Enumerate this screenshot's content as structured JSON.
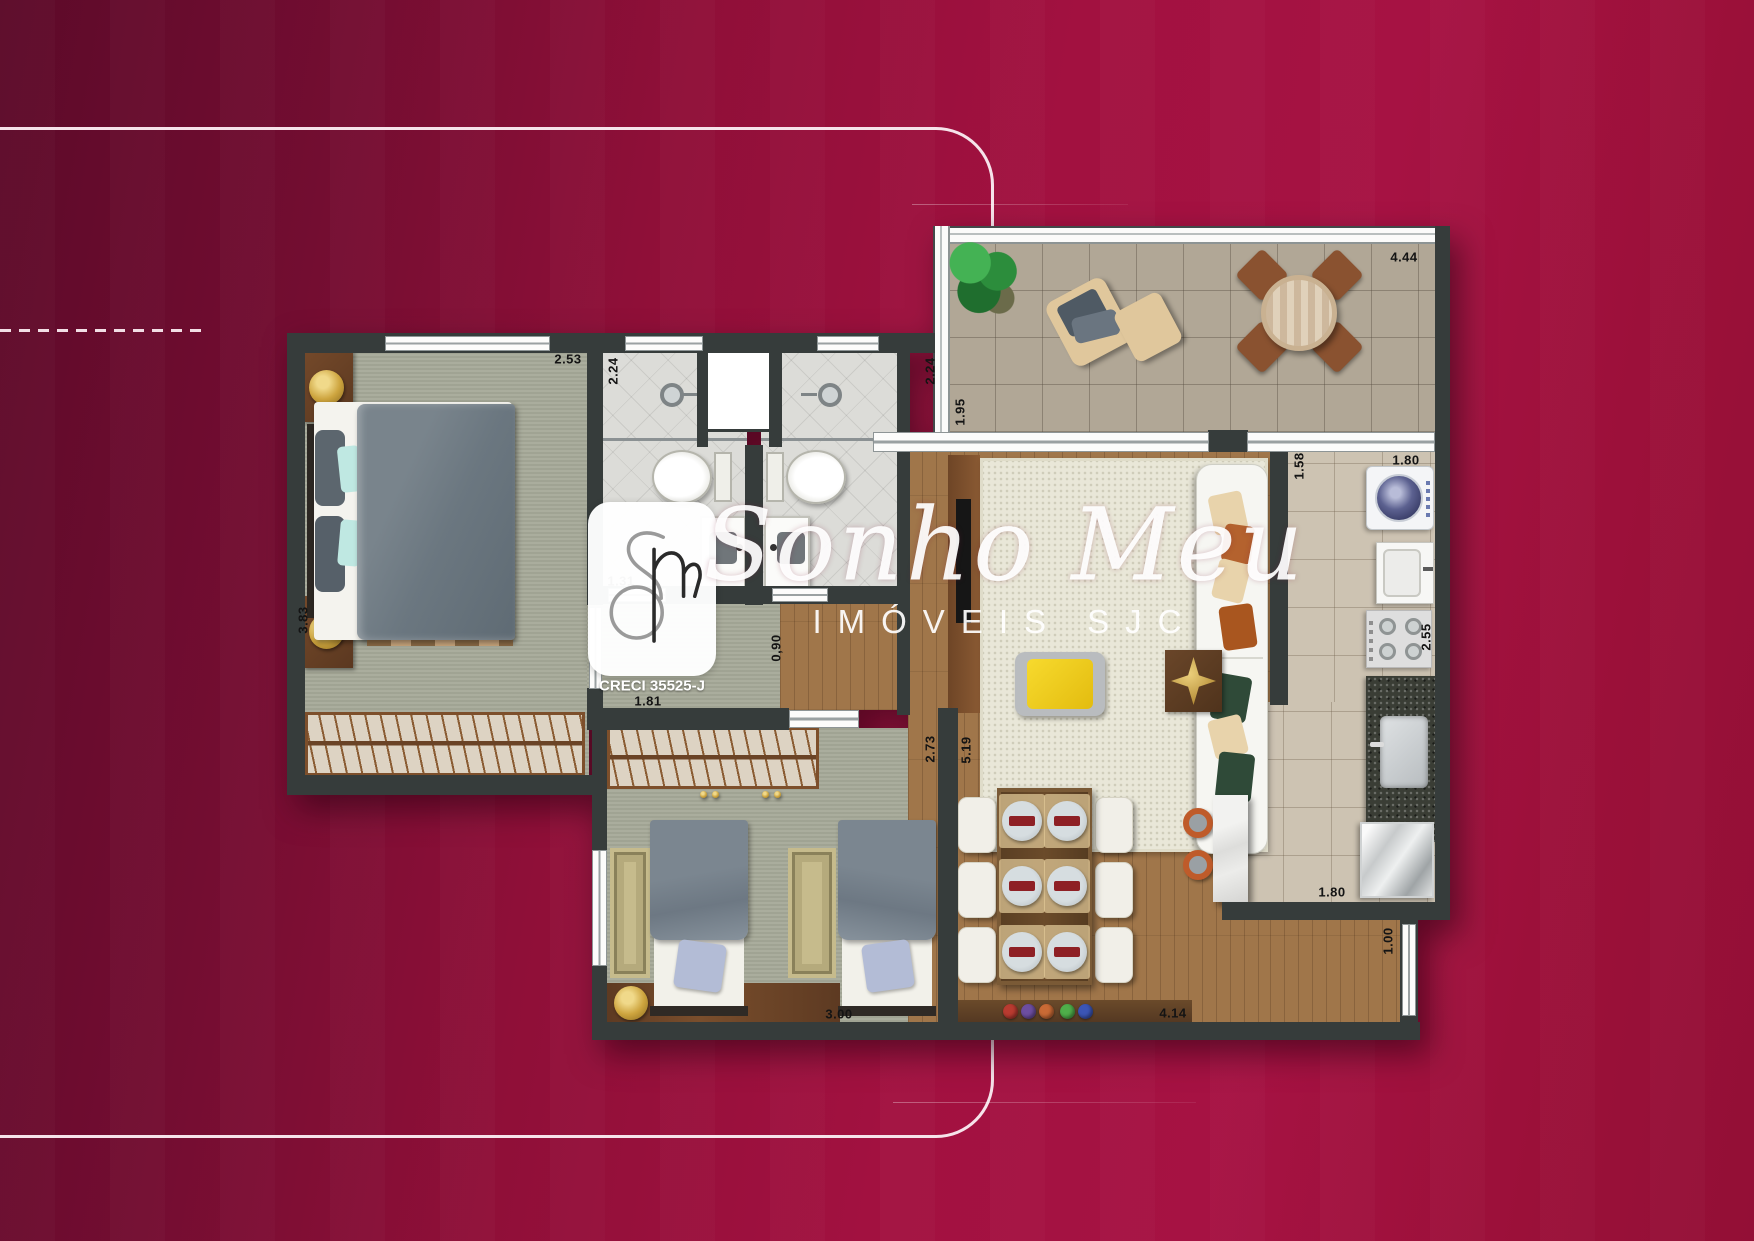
{
  "watermark": {
    "brand": "Sonho Meu",
    "subtitle": "IMÓVEIS SJC",
    "creci": "CRECI 35525-J",
    "monogram": "SM"
  },
  "colors": {
    "background_accent": "#a21140",
    "background_dark": "#5c0a29",
    "wall": "#363c3b",
    "decor_line": "#f6e3ea",
    "highlight_cushion": "#f3cf1a"
  },
  "dims": {
    "master_width": "2.53",
    "master_depth": "3.83",
    "bath1_depth": "2.24",
    "bath2_depth": "2.24",
    "bath1_width": "1.31",
    "hall_width": "0,90",
    "closet_wall": "1.81",
    "terrace_width": "4.44",
    "terrace_depth": "1.95",
    "kitchen_entry": "1.58",
    "laundry_width": "1.80",
    "kitchen_depth": "2.55",
    "kitchen_width": "1.80",
    "bedroom2_width": "3.00",
    "bedroom2_depth": "2.73",
    "living_depth": "5.19",
    "living_width": "4.14",
    "service_door": "1.00"
  }
}
